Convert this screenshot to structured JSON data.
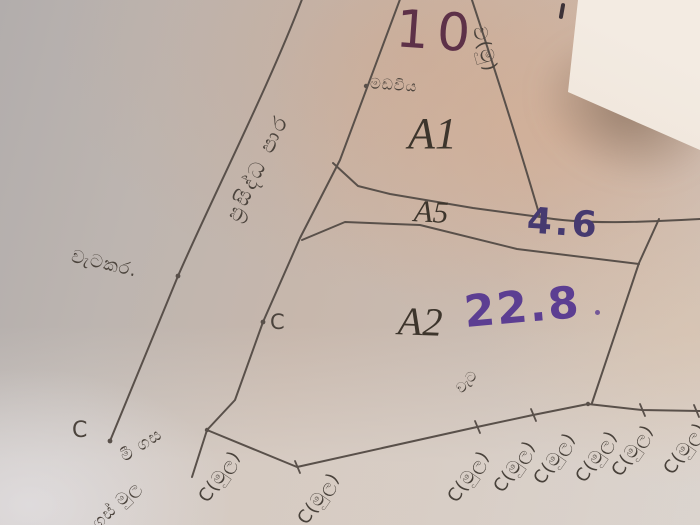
{
  "plan": {
    "lot_number_top": "10",
    "lots": [
      {
        "label": "A1",
        "measurement": ""
      },
      {
        "label": "A5",
        "measurement": "4.6"
      },
      {
        "label": "A2",
        "measurement": "22.8"
      }
    ],
    "road_label": "ප්‍රසිද්ධ පාර",
    "fence_label": "වැටකර.",
    "small_label_top": "මඩවිය",
    "side_mark": "ව(මු)",
    "point_label_mid": "C",
    "point_label_corner": "C",
    "tree_mark_label": "මී ගස",
    "corner_mark_label": "ගස් මුල",
    "fence_small_label": "වැට",
    "boundary_marks": [
      "C(මුල)",
      "C(මුල)",
      "C(මුල)",
      "C(මුල)",
      "C(මුල)",
      "C(මුල)",
      "C(මුල)",
      "C(මුල)"
    ],
    "colors": {
      "pencil_line": "#59504a",
      "ink_maroon": "#5d3148",
      "ink_purple": "#5c3e92",
      "ink_indigo": "#463a70"
    }
  }
}
